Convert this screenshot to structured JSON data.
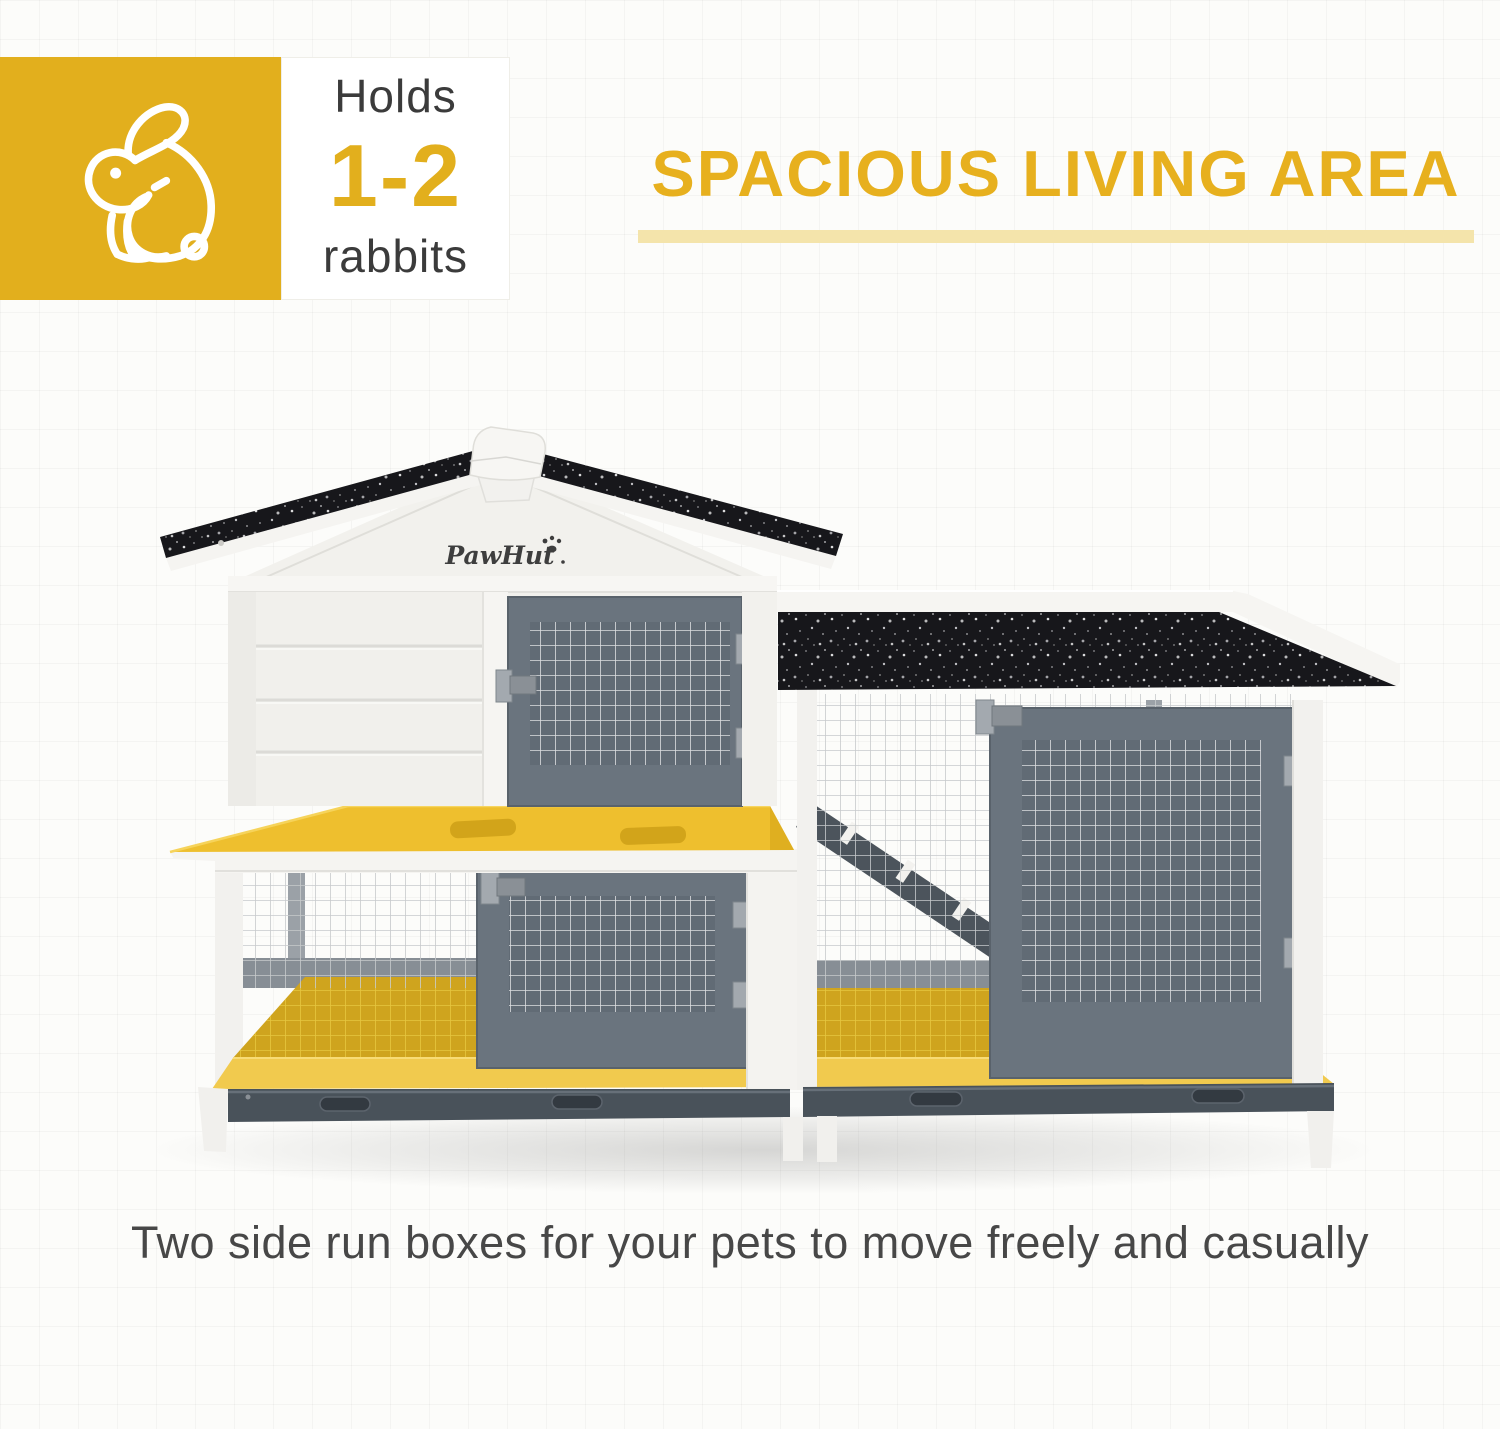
{
  "capacity_badge": {
    "label_top": "Holds",
    "value": "1-2",
    "label_bottom": "rabbits"
  },
  "headline": {
    "text": "SPACIOUS LIVING AREA"
  },
  "hutch": {
    "brand": "PawHut"
  },
  "caption": {
    "text": "Two side run boxes for your pets to move freely and casually"
  },
  "icons": {
    "badge": "rabbit-outline-icon",
    "logo_mark": "paw-print-icon"
  },
  "colors": {
    "accent_yellow": "#E2AF1D",
    "heading_yellow": "#E7B01E",
    "underline_yellow": "#F4E4AB",
    "highlight_platform": "#EEBF2E",
    "highlight_floor": "#CFA41E",
    "highlight_front_band": "#F1CA4E",
    "dark_text": "#3B3B3B",
    "caption_text": "#474747",
    "roof_black": "#17171B",
    "door_gray": "#6A747E",
    "tray_gray": "#49525A",
    "wood_white": "#F3F2EF",
    "mesh_gray": "#C7CACC"
  }
}
